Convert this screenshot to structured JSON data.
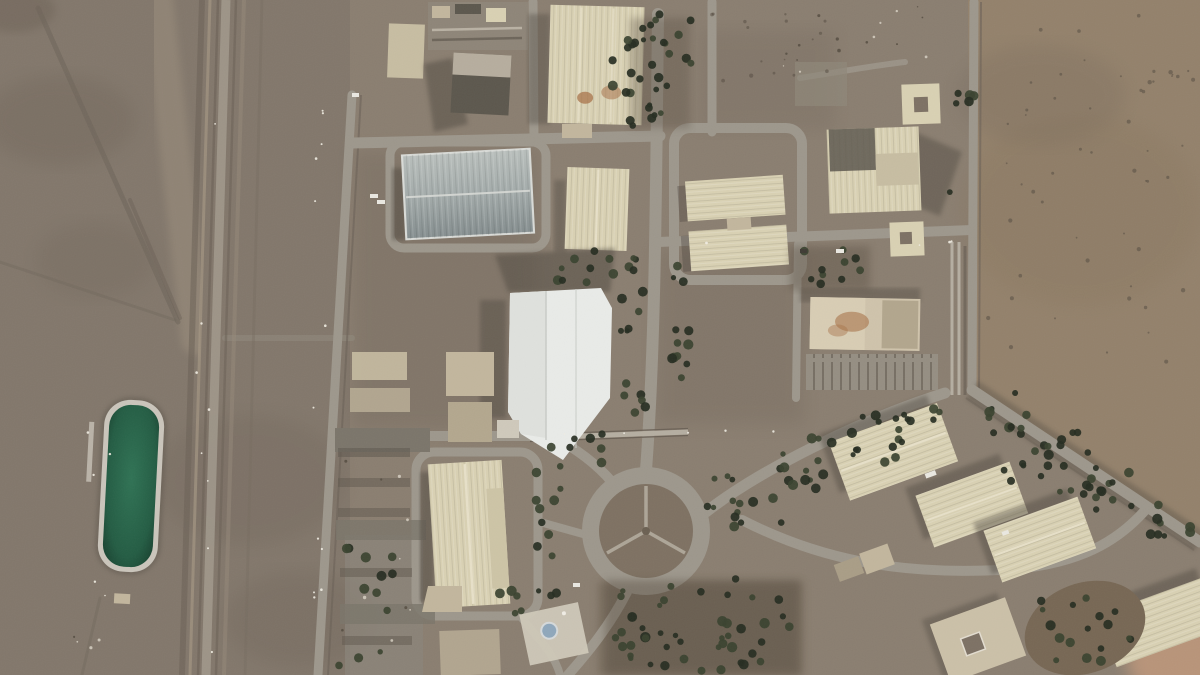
{
  "meta": {
    "title": "Satellite overhead view of a desert industrial facility with warehouses, tree-lined roads, a traffic roundabout and a green water pond",
    "kind": "satellite-image",
    "visible_text": "none"
  },
  "palette": {
    "desert_base": "#8a7e70",
    "desert_left": "#80766a",
    "desert_right": "#93816b",
    "desert_dark": "#6c6054",
    "desert_light": "#a49683",
    "sand_pink": "#c49a7c",
    "facility_dirt": "#7d7164",
    "road": "#9d978c",
    "road_light": "#b5aea1",
    "fence_line": "#6b6156",
    "bldg_cream": "#d9d1b3",
    "bldg_cream_dark": "#c7bda2",
    "bldg_tan": "#c2b69d",
    "roof_metal_a": "#b4bab8",
    "roof_metal_b": "#879091",
    "roof_white": "#e9ebe8",
    "roof_dark": "#5c574d",
    "stain_rust": "#a8734a",
    "pool_green": "#1b4c37",
    "pool_green_light": "#2f7254",
    "pool_rim": "#cac5bb",
    "tree": "#39422f",
    "tree_dark": "#262d21",
    "rock_dark": "#554c41",
    "light_dot": "#f1ede3",
    "debris_light": "#d6cfc2",
    "shadow": "#4f4840",
    "car_white": "#eae8e1",
    "car_dark": "#3f3b34",
    "dome_blue": "#8fa7bb"
  },
  "features": {
    "cooling_pond": "rectangular green water pond west of the rail corridor",
    "rail_corridor": "north-south track and road corridor on the west side",
    "roundabout": "landscaped traffic circle with Y-shaped paths, lower centre",
    "warehouse_count_large": 12,
    "tree_lined_avenue": "north-south avenue through facility centre",
    "white_building": "large bright-white roofed hall at centre",
    "mosque": "small blue-domed structure south of the roundabout",
    "perimeter": "diagonal tree-lined perimeter road, south-east"
  },
  "scatter": {
    "seed": 20240117,
    "layers": [
      {
        "target": "trees-layer",
        "item_name": "tree",
        "color": "tree",
        "color_dark": "tree_dark",
        "dark_ratio": 0.5,
        "rmin": 2.6,
        "rmax": 5.2,
        "opacity": 0.92,
        "clusters": [
          {
            "x": 628,
            "y": 14,
            "w": 66,
            "h": 112,
            "count": 26
          },
          {
            "x": 612,
            "y": 20,
            "w": 22,
            "h": 100,
            "count": 8
          },
          {
            "x": 620,
            "y": 252,
            "w": 28,
            "h": 165,
            "count": 16
          },
          {
            "x": 670,
            "y": 255,
            "w": 26,
            "h": 130,
            "count": 12
          },
          {
            "x": 556,
            "y": 250,
            "w": 62,
            "h": 42,
            "count": 9
          },
          {
            "x": 548,
            "y": 430,
            "w": 62,
            "h": 38,
            "count": 8
          },
          {
            "x": 536,
            "y": 468,
            "w": 26,
            "h": 132,
            "count": 12
          },
          {
            "x": 610,
            "y": 578,
            "w": 185,
            "h": 95,
            "count": 46
          },
          {
            "x": 703,
            "y": 468,
            "w": 62,
            "h": 46,
            "count": 8
          },
          {
            "x": 762,
            "y": 438,
            "w": 70,
            "h": 40,
            "count": 8
          },
          {
            "x": 832,
            "y": 412,
            "w": 72,
            "h": 36,
            "count": 8
          },
          {
            "x": 898,
            "y": 392,
            "w": 52,
            "h": 30,
            "count": 6
          },
          {
            "x": 722,
            "y": 498,
            "w": 60,
            "h": 30,
            "count": 6
          },
          {
            "x": 784,
            "y": 468,
            "w": 60,
            "h": 28,
            "count": 6
          },
          {
            "x": 850,
            "y": 440,
            "w": 58,
            "h": 26,
            "count": 6
          },
          {
            "x": 972,
            "y": 392,
            "w": 62,
            "h": 42,
            "count": 10
          },
          {
            "x": 1030,
            "y": 430,
            "w": 62,
            "h": 42,
            "count": 10
          },
          {
            "x": 1086,
            "y": 466,
            "w": 60,
            "h": 40,
            "count": 10
          },
          {
            "x": 1138,
            "y": 502,
            "w": 55,
            "h": 36,
            "count": 8
          },
          {
            "x": 1000,
            "y": 452,
            "w": 52,
            "h": 30,
            "count": 6
          },
          {
            "x": 1052,
            "y": 482,
            "w": 52,
            "h": 30,
            "count": 6
          },
          {
            "x": 1038,
            "y": 592,
            "w": 100,
            "h": 72,
            "count": 17
          },
          {
            "x": 793,
            "y": 246,
            "w": 72,
            "h": 44,
            "count": 10
          },
          {
            "x": 498,
            "y": 586,
            "w": 32,
            "h": 30,
            "count": 5
          },
          {
            "x": 338,
            "y": 542,
            "w": 64,
            "h": 126,
            "count": 12
          },
          {
            "x": 948,
            "y": 45,
            "w": 26,
            "h": 185,
            "count": 6
          }
        ]
      },
      {
        "target": "rocks-layer",
        "item_name": "rock",
        "color": "rock_dark",
        "color_dark": "rock_dark",
        "dark_ratio": 0,
        "rmin": 0.8,
        "rmax": 2.2,
        "opacity": 0.55,
        "clusters": [
          {
            "x": 988,
            "y": 15,
            "w": 205,
            "h": 360,
            "count": 48
          },
          {
            "x": 700,
            "y": 8,
            "w": 130,
            "h": 85,
            "count": 16
          },
          {
            "x": 1148,
            "y": 70,
            "w": 50,
            "h": 20,
            "count": 6
          }
        ]
      },
      {
        "target": "lights-layer",
        "item_name": "light-pole",
        "color": "light_dot",
        "color_dark": "light_dot",
        "dark_ratio": 0,
        "rmin": 0.8,
        "rmax": 1.4,
        "opacity": 0.9,
        "clusters": [
          {
            "x": 312,
            "y": 100,
            "w": 16,
            "h": 570,
            "count": 12
          },
          {
            "x": 196,
            "y": 20,
            "w": 22,
            "h": 640,
            "count": 8
          },
          {
            "x": 80,
            "y": 385,
            "w": 30,
            "h": 230,
            "count": 5
          },
          {
            "x": 560,
            "y": 430,
            "w": 230,
            "h": 12,
            "count": 5
          },
          {
            "x": 660,
            "y": 240,
            "w": 300,
            "h": 10,
            "count": 4
          }
        ]
      },
      {
        "target": "debris-layer",
        "item_name": "debris",
        "color": "debris_light",
        "color_dark": "rock_dark",
        "dark_ratio": 0.4,
        "rmin": 0.7,
        "rmax": 1.8,
        "opacity": 0.85,
        "clusters": [
          {
            "x": 775,
            "y": 2,
            "w": 185,
            "h": 70,
            "count": 16
          },
          {
            "x": 60,
            "y": 625,
            "w": 40,
            "h": 30,
            "count": 4
          },
          {
            "x": 336,
            "y": 445,
            "w": 80,
            "h": 210,
            "count": 10
          }
        ]
      }
    ]
  }
}
